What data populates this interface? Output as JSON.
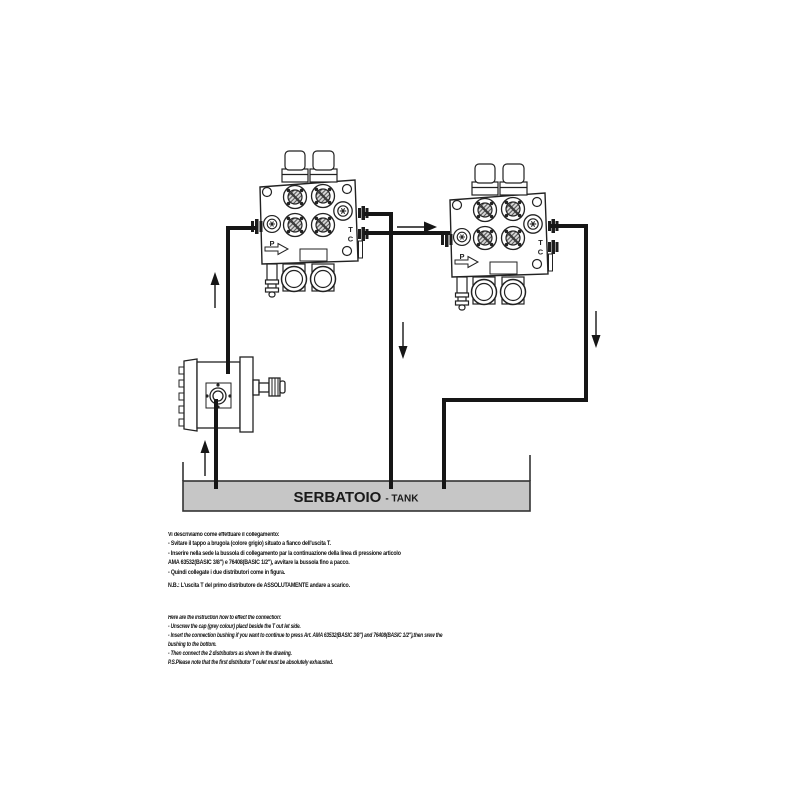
{
  "diagram": {
    "port_labels": {
      "p": "P",
      "t": "T",
      "c": "C"
    },
    "tank": {
      "name": "SERBATOIO",
      "subtitle": "- TANK",
      "fill_color": "#c6c6c6"
    },
    "colors": {
      "line": "#161616",
      "tank_border": "#333333"
    }
  },
  "instructions_it": {
    "lines": [
      "Vi descriviamo come effettuare il collegamento:",
      "- Svitare il tappo a brugola (colore grigio) situato a fianco dell'uscita T.",
      "- Inserire nella sede la bussola di collegamento par la continuazione della linea di pressione articolo",
      "AMA 63532(BASIC 3/8\") e 76408(BASIC 1/2\"), avvitare la bussola fino a pacco.",
      "- Quindi collegate i due distributori come in figura.",
      "N.B.: L'uscita T del primo distributore de ASSOLUTAMENTE andare a scarico."
    ]
  },
  "instructions_en": {
    "lines": [
      "Here are the instruction how to effect the connection:",
      "- Unscrew the cap (grey colour) placd beside the T out let side.",
      "- Insert the connection bushing if you want to continue to press Art. AMA 63532(BASIC 3/8\") and 76408(BASIC 1/2\"),then srew the",
      "bushing to the bottom.",
      "- Then connect the 2 distributors as shown in the drawing.",
      "P.S.Please note that the first distributor T oulet must be absolutely exhausted."
    ]
  }
}
